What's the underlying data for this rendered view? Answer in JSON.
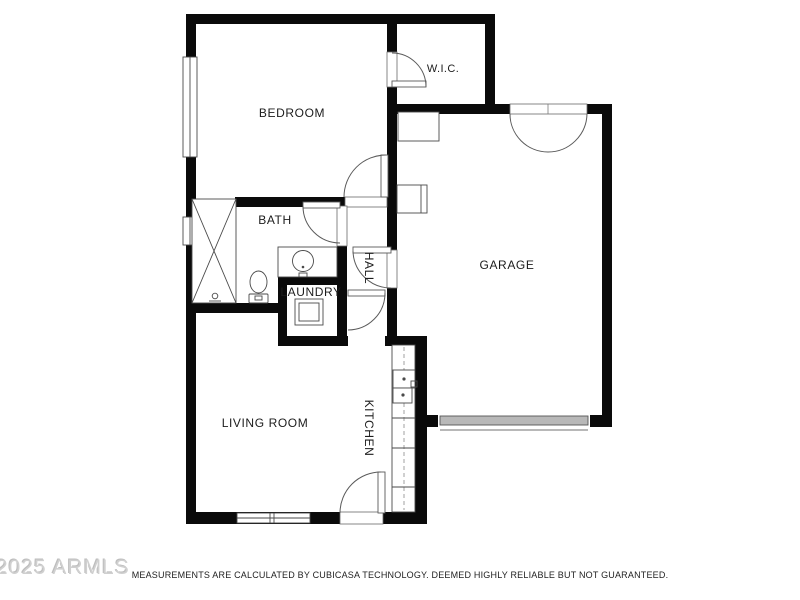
{
  "floorplan": {
    "rooms": {
      "bedroom": "BEDROOM",
      "wic": "W.I.C.",
      "garage": "GARAGE",
      "bath": "BATH",
      "hall": "HALL",
      "laundry": "LAUNDRY",
      "kitchen": "KITCHEN",
      "living_room": "LIVING ROOM"
    },
    "colors": {
      "wall": "#0a0a0a",
      "garage_door": "#b8b8b8",
      "thin_line": "#4a4a4a",
      "watermark": "#d0d0d0"
    }
  },
  "footer": {
    "watermark": "2025 ARMLS",
    "disclaimer": "MEASUREMENTS ARE CALCULATED BY CUBICASA TECHNOLOGY. DEEMED HIGHLY RELIABLE BUT NOT GUARANTEED."
  }
}
